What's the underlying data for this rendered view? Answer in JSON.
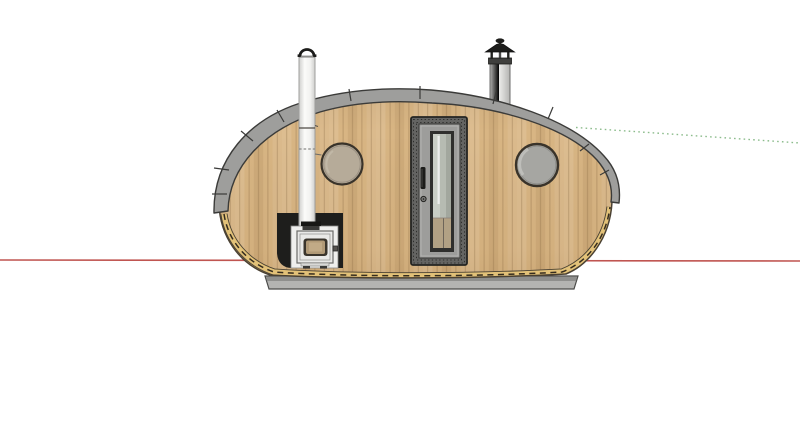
{
  "canvas": {
    "background": "#ffffff"
  },
  "axes": {
    "red_color": "#c05551",
    "green_color": "#8cbc8c"
  },
  "pod": {
    "wood": "#d8b583",
    "wood_outline": "#4a4133",
    "roof": "#9e9e9c",
    "roof_outline": "#3b3b39",
    "trim": "#e2c178",
    "trim_stitch": "#352c1e",
    "base_slab": "#b4b4b2",
    "base_slab_dark": "#8f8f8d"
  },
  "door": {
    "frame": "#646462",
    "frame_stitch": "#2e2e2c",
    "leaf": "#9d9d9b",
    "glass_frame": "#2f2f2d",
    "glass": "#b6bbb2",
    "glass_reflection": "#f0f2ee",
    "interior_reflection": "#b2a184",
    "handle": "#1c1c1a"
  },
  "portholes": {
    "count": 2,
    "left_glass": "#b6ab99",
    "right_glass": "#a6a6a2",
    "rim": "#39332a"
  },
  "stove": {
    "heat_shield": "#1e1e1c",
    "backing": "#efefed",
    "body": "#e9e9e7",
    "window_frame": "#3a352c",
    "window_glass": "#b19a77",
    "collar": "#171715"
  },
  "flue": {
    "pipe_light": "#fafaf8",
    "pipe_shade": "#d6d6d4",
    "cap_hoop": "#1c1c1a"
  },
  "chimney": {
    "pipe": "#e6e6e4",
    "cap": "#1d1d1b",
    "collar": "#3f3f3d"
  }
}
